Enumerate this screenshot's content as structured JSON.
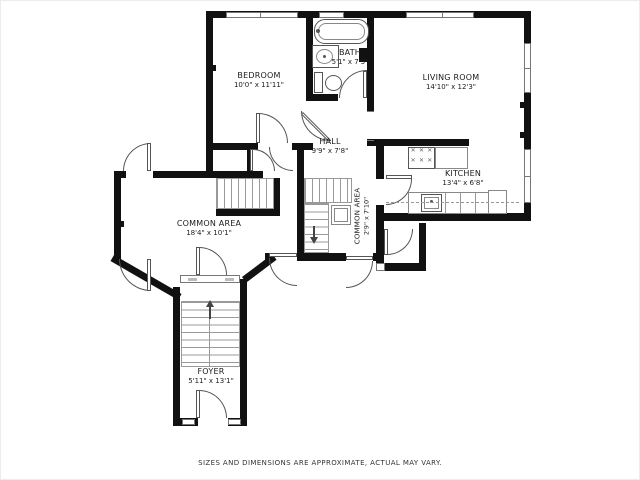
{
  "plan": {
    "rooms": {
      "bedroom": {
        "name": "BEDROOM",
        "dims": "10'0\" x 11'11\""
      },
      "bath": {
        "name": "BATH",
        "dims": "5'1\" x 7'3\""
      },
      "living_room": {
        "name": "LIVING ROOM",
        "dims": "14'10\" x 12'3\""
      },
      "hall": {
        "name": "HALL",
        "dims": "9'9\" x 7'8\""
      },
      "kitchen": {
        "name": "KITCHEN",
        "dims": "13'4\" x 6'8\""
      },
      "common_area": {
        "name": "COMMON AREA",
        "dims": "18'4\" x 10'1\""
      },
      "common_area_stair": {
        "name": "COMMON AREA",
        "dims": "2'9\" x 7'10\""
      },
      "foyer": {
        "name": "FOYER",
        "dims": "5'11\" x 13'1\""
      }
    },
    "footer": {
      "disclaimer": "SIZES AND DIMENSIONS ARE APPROXIMATE, ACTUAL MAY VARY."
    },
    "colors": {
      "wall": "#111111",
      "fixture_line": "#555555",
      "stair_line": "#9a9a9a",
      "text": "#1c1c1c"
    }
  }
}
